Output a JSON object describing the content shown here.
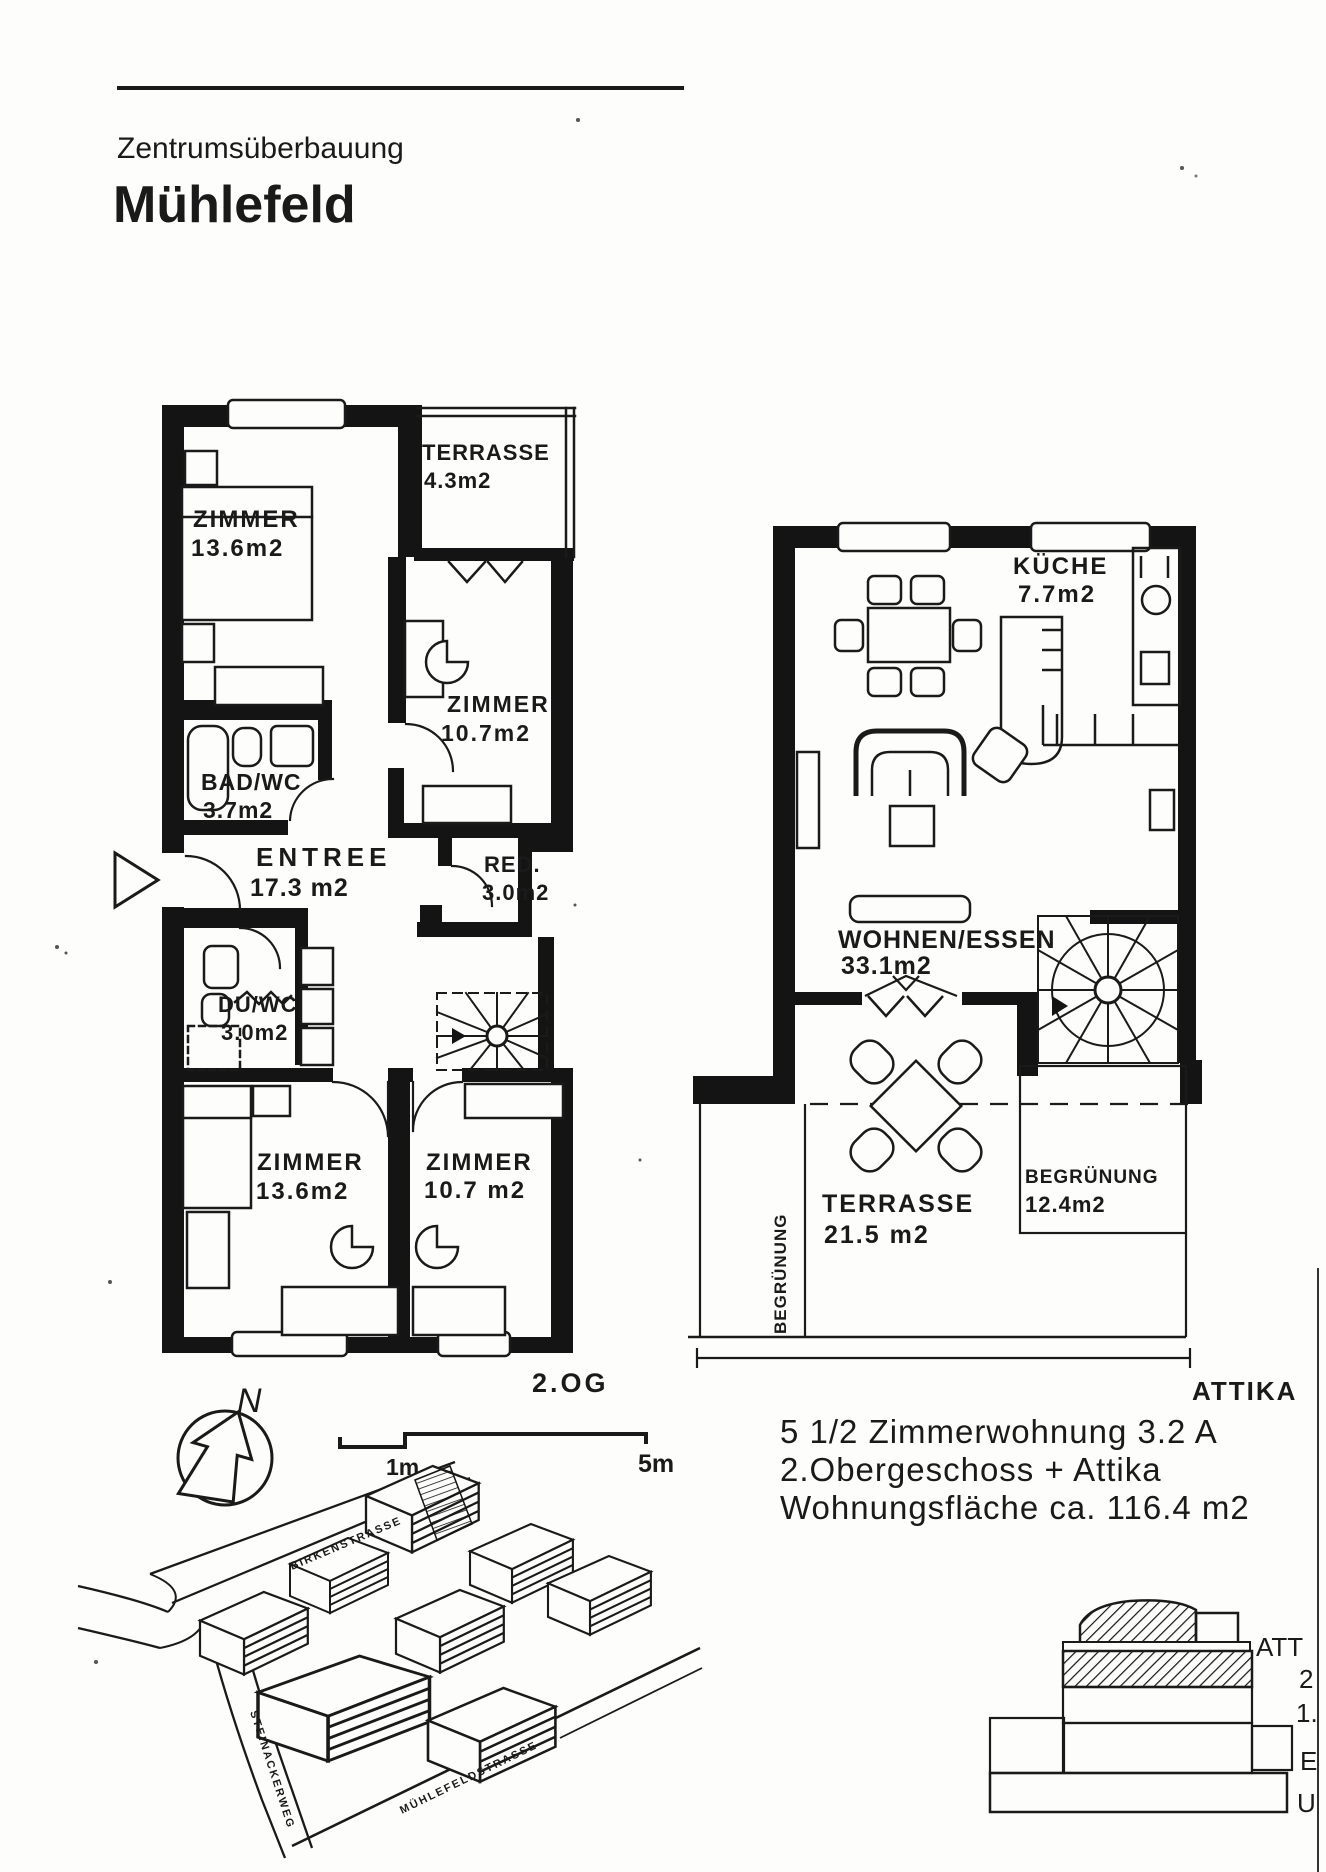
{
  "header": {
    "project_type": "Zentrumsüberbauung",
    "project_name": "Mühlefeld"
  },
  "plan_2og": {
    "floor_label": "2.OG",
    "rooms": [
      {
        "name": "TERRASSE",
        "area": "4.3m2"
      },
      {
        "name": "ZIMMER",
        "area": "13.6m2"
      },
      {
        "name": "ZIMMER",
        "area": "10.7m2"
      },
      {
        "name": "BAD/WC",
        "area": "3.7m2"
      },
      {
        "name": "ENTREE",
        "area": "17.3 m2"
      },
      {
        "name": "RED.",
        "area": "3.0m2"
      },
      {
        "name": "DU/WC",
        "area": "3.0m2"
      },
      {
        "name": "ZIMMER",
        "area": "13.6m2"
      },
      {
        "name": "ZIMMER",
        "area": "10.7 m2"
      }
    ]
  },
  "plan_attika": {
    "level_label": "ATTIKA",
    "rooms": [
      {
        "name": "KÜCHE",
        "area": "7.7m2"
      },
      {
        "name": "WOHNEN/ESSEN",
        "area": "33.1m2"
      },
      {
        "name": "TERRASSE",
        "area": "21.5 m2"
      },
      {
        "name": "BEGRÜNUNG",
        "area": "12.4m2"
      },
      {
        "name": "BEGRÜNUNG",
        "area": ""
      }
    ]
  },
  "annotation": {
    "line1": "5 1/2 Zimmerwohnung 3.2 A",
    "line2": "2.Obergeschoss + Attika",
    "line3": "Wohnungsfläche ca. 116.4 m2"
  },
  "scale_bar": {
    "near_label": "1m",
    "far_label": "5m"
  },
  "north_arrow": {
    "label": "N"
  },
  "site_map": {
    "streets": [
      {
        "name": "BIRKENSTRASSE"
      },
      {
        "name": "STEINACKERWEG"
      },
      {
        "name": "MÜHLEFELDSTRASSE"
      }
    ]
  },
  "section": {
    "labels": [
      {
        "text": "ATT"
      },
      {
        "text": "2"
      },
      {
        "text": "1."
      },
      {
        "text": "E"
      },
      {
        "text": "U"
      }
    ]
  },
  "colors": {
    "ink": "#1a1a1a",
    "paper": "#fdfdfb"
  }
}
